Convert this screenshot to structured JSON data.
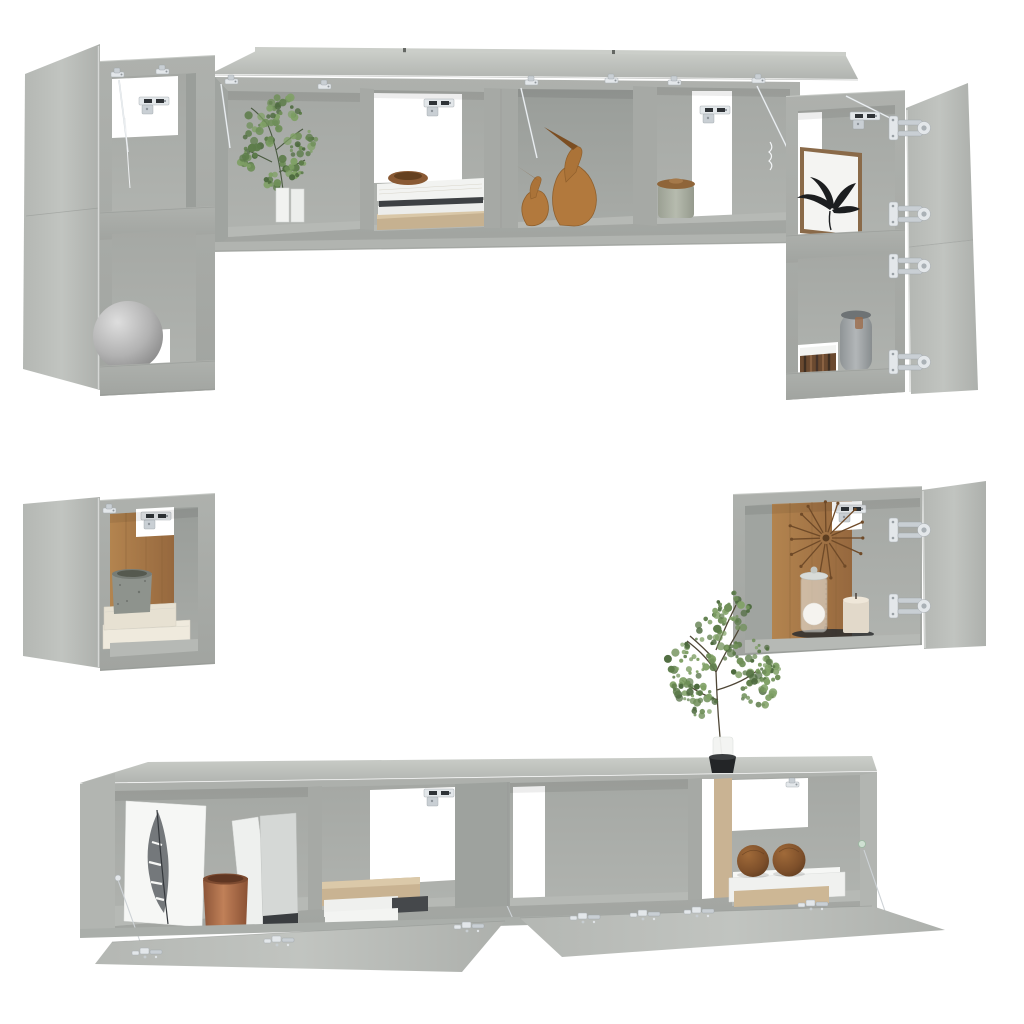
{
  "image": {
    "kind": "product-photo-render",
    "subject": "Wall-mounted TV cabinet set in concrete gray shown floating on white, doors open, styled with decor",
    "background": "#ffffff"
  },
  "palette": {
    "concrete_light": "#c6c9c5",
    "concrete_mid": "#a8aba7",
    "concrete_dark": "#989c98",
    "interior_wood": "#a97b4f",
    "metal_hardware": "#dfe3e6",
    "accent_copper": "#9c6b4a",
    "plant_green": "#5d7c4a",
    "decor_wood": "#b0783c"
  },
  "pieces": [
    {
      "id": "top-left-stack",
      "label": "Stacked wall cabinets with open side doors and a sphere lamp"
    },
    {
      "id": "top-shelf",
      "label": "Wall shelf cabinets with flip-up doors holding a plant, books, a bowl, bird figurines and a jar"
    },
    {
      "id": "top-right-stack",
      "label": "Stacked wall cabinets with doors open right, leaf art print, vase and books"
    },
    {
      "id": "mid-left-cube",
      "label": "Small wall cube cabinet with stone pot and cream books"
    },
    {
      "id": "mid-right-cube",
      "label": "Small wall cube cabinet with sunburst clock, jar candle and pillar candle"
    },
    {
      "id": "bottom-stand",
      "label": "Hanging TV stands with flip-down doors, feather print, copper pot, binders, books and wooden spheres"
    },
    {
      "id": "decor-plant",
      "label": "Artificial plant in white vase with black pot on the TV stand"
    }
  ]
}
